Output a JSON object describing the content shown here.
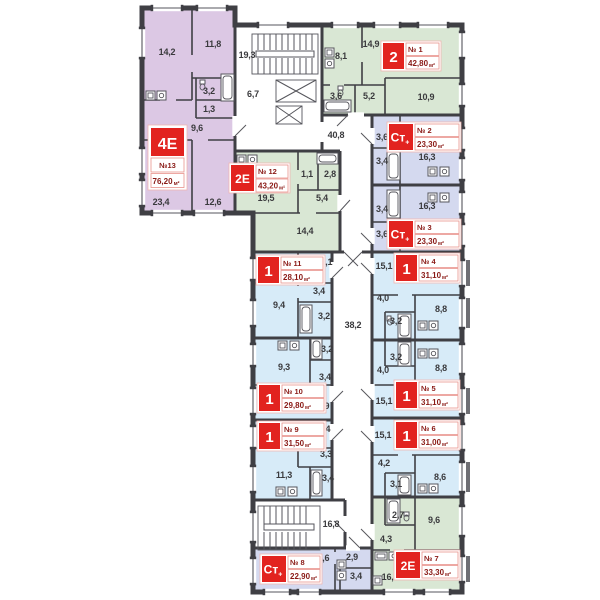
{
  "page": {
    "background": "#ffffff",
    "description": "Residential floor plan, 13 apartments with common corridors, stairs and elevators"
  },
  "units": {
    "area_suffix": "м²"
  },
  "colors": {
    "wall": "#3f3f44",
    "fill_type_1": "#d7ebf8",
    "fill_type_2": "#d9e7d4",
    "fill_type_4e": "#dcc8e4",
    "fill_type_st": "#d4d9ef",
    "label_red": "#e2231f",
    "label_text": "#8a1a16"
  },
  "common_areas": {
    "stairwell_top": "19,3",
    "elevator_lobby": "6,7",
    "corridor_upper": "40,8",
    "corridor_main": "38,2",
    "stairwell_bottom": "16,8"
  },
  "apartments": [
    {
      "number": "№ 1",
      "type": "2",
      "type_suffix": "",
      "area": "42,80",
      "rooms": [
        "8,1",
        "14,9",
        "3,6",
        "5,2",
        "10,9"
      ]
    },
    {
      "number": "№ 2",
      "type": "Ст",
      "type_suffix": "+",
      "area": "23,30",
      "rooms": [
        "3,6",
        "3,4",
        "16,3"
      ]
    },
    {
      "number": "№ 3",
      "type": "Ст",
      "type_suffix": "+",
      "area": "23,30",
      "rooms": [
        "16,3",
        "3,4",
        "3,6"
      ]
    },
    {
      "number": "№ 4",
      "type": "1",
      "type_suffix": "",
      "area": "31,10",
      "rooms": [
        "15,1",
        "4,0",
        "8,8",
        "3,2"
      ]
    },
    {
      "number": "№ 5",
      "type": "1",
      "type_suffix": "",
      "area": "31,10",
      "rooms": [
        "8,8",
        "3,2",
        "4,0",
        "15,1"
      ]
    },
    {
      "number": "№ 6",
      "type": "1",
      "type_suffix": "",
      "area": "31,00",
      "rooms": [
        "15,1",
        "4,2",
        "8,6",
        "3,1"
      ]
    },
    {
      "number": "№ 7",
      "type": "2Е",
      "type_suffix": "",
      "area": "33,30",
      "rooms": [
        "2,7",
        "9,6",
        "4,3",
        "16,8"
      ]
    },
    {
      "number": "№ 8",
      "type": "Ст",
      "type_suffix": "+",
      "area": "22,90",
      "rooms": [
        "16,6",
        "2,9",
        "3,4"
      ]
    },
    {
      "number": "№ 9",
      "type": "1",
      "type_suffix": "",
      "area": "31,50",
      "rooms": [
        "13,4",
        "3,3",
        "11,3",
        "3,4"
      ]
    },
    {
      "number": "№ 10",
      "type": "1",
      "type_suffix": "",
      "area": "29,80",
      "rooms": [
        "3,2",
        "9,3",
        "3,4",
        "13,9"
      ]
    },
    {
      "number": "№ 11",
      "type": "1",
      "type_suffix": "",
      "area": "28,10",
      "rooms": [
        "12,1",
        "3,4",
        "9,4",
        "3,2"
      ]
    },
    {
      "number": "№ 12",
      "type": "2Е",
      "type_suffix": "",
      "area": "43,20",
      "rooms": [
        "19,5",
        "1,1",
        "2,8",
        "5,4",
        "14,4"
      ]
    },
    {
      "number": "№13",
      "type": "4Е",
      "type_suffix": "",
      "area": "76,20",
      "rooms": [
        "14,2",
        "11,8",
        "3,2",
        "1,3",
        "9,6",
        "23,4",
        "12,6"
      ]
    }
  ]
}
